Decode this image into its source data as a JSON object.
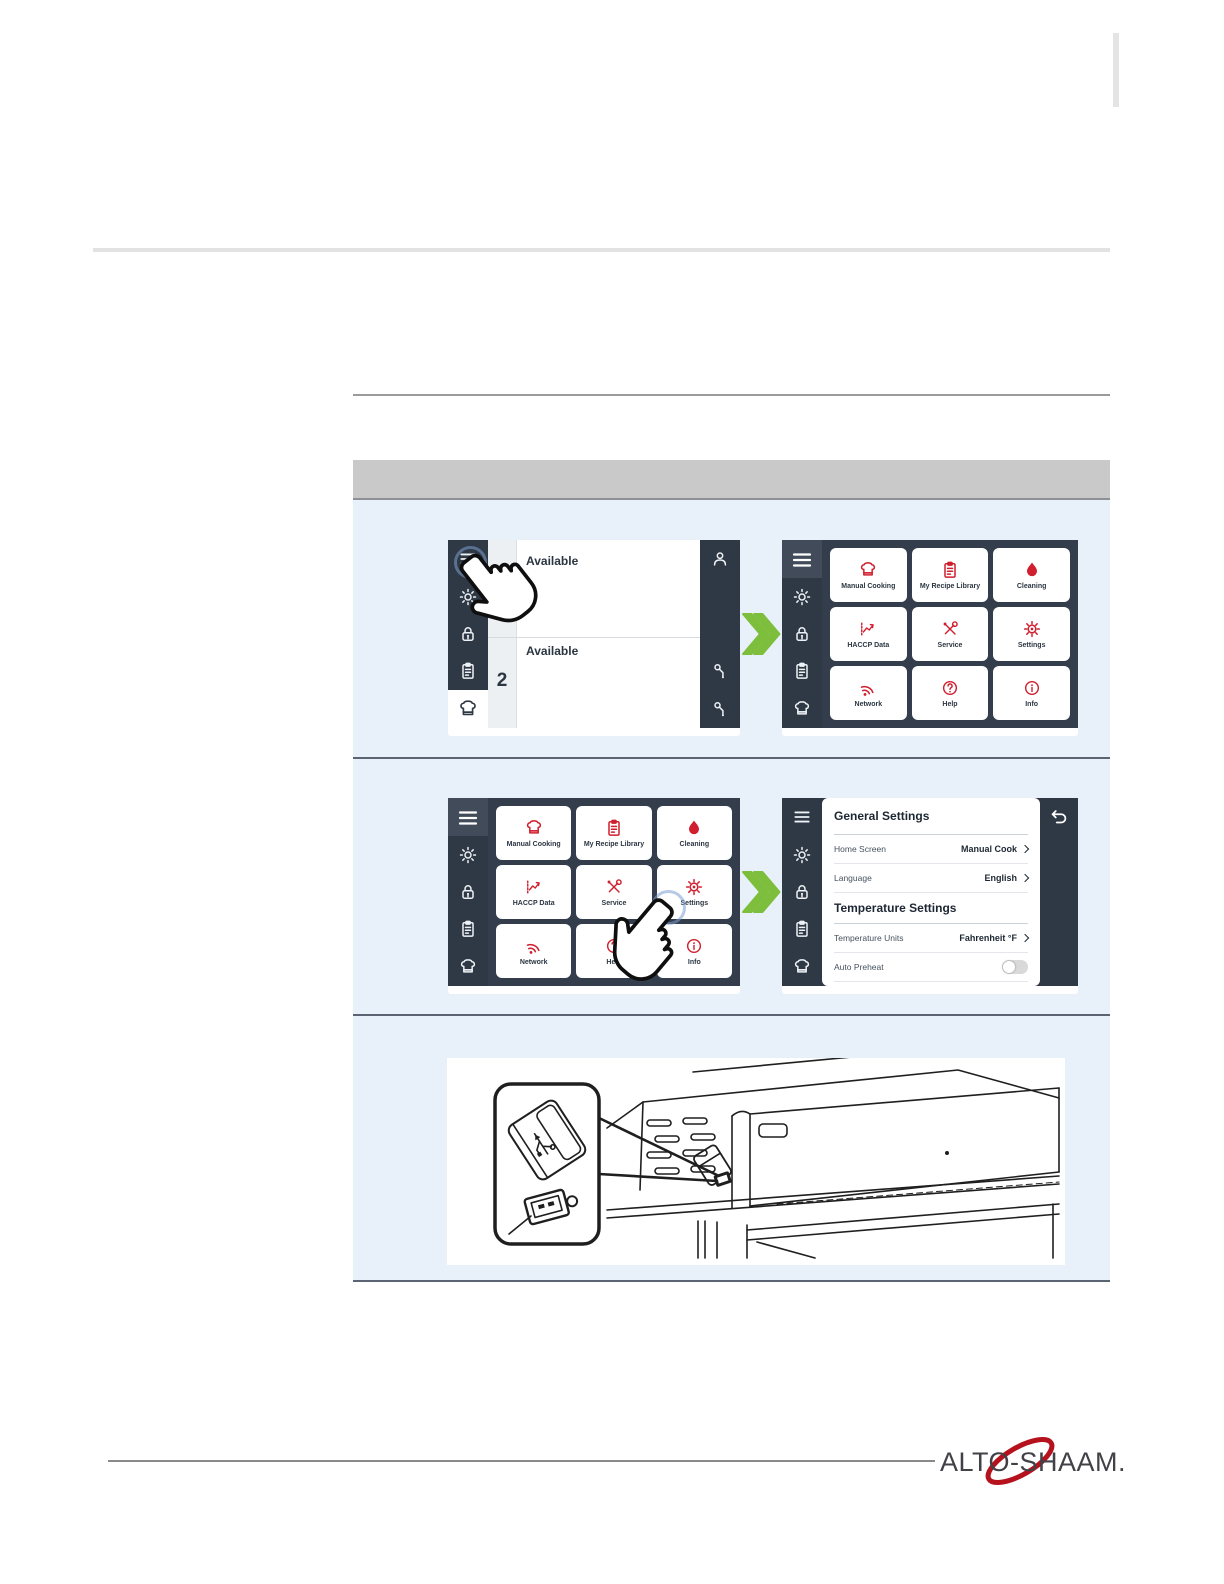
{
  "colors": {
    "accent_red": "#D01F2E",
    "ui_dark_navy": "#2F3845",
    "panel_light_blue": "#E8F1FA",
    "arrow_green": "#7DBE3C",
    "logo_red": "#B5121D",
    "table_header_gray": "#C9C9C9"
  },
  "oven_ui": {
    "sidebar_icons": [
      "menu-icon",
      "brightness-icon",
      "lock-icon",
      "recipes-icon",
      "chef-hat-icon"
    ],
    "home_screen": {
      "shelves": [
        {
          "status": "Available",
          "number": ""
        },
        {
          "status": "Available",
          "number": "2"
        }
      ],
      "right_rail_icons": [
        "user-icon",
        "probe-icon",
        "probe-icon"
      ]
    },
    "menu_screen": {
      "tiles": [
        {
          "label": "Manual Cooking",
          "icon": "chef-hat-icon"
        },
        {
          "label": "My Recipe Library",
          "icon": "recipe-book-icon"
        },
        {
          "label": "Cleaning",
          "icon": "droplet-icon"
        },
        {
          "label": "HACCP Data",
          "icon": "chart-icon"
        },
        {
          "label": "Service",
          "icon": "tools-icon"
        },
        {
          "label": "Settings",
          "icon": "gear-icon"
        },
        {
          "label": "Network",
          "icon": "network-icon"
        },
        {
          "label": "Help",
          "icon": "help-icon"
        },
        {
          "label": "Info",
          "icon": "info-icon"
        }
      ]
    },
    "settings_screen": {
      "section1": "General Settings",
      "rows1": [
        {
          "label": "Home Screen",
          "value": "Manual Cook"
        },
        {
          "label": "Language",
          "value": "English"
        }
      ],
      "section2": "Temperature Settings",
      "rows2": [
        {
          "label": "Temperature Units",
          "value": "Fahrenheit °F"
        }
      ],
      "toggle_row": {
        "label": "Auto Preheat",
        "state": "off"
      },
      "back_icon": "back-arrow-icon"
    }
  },
  "footer": {
    "brand": "ALTO-SHAAM."
  }
}
